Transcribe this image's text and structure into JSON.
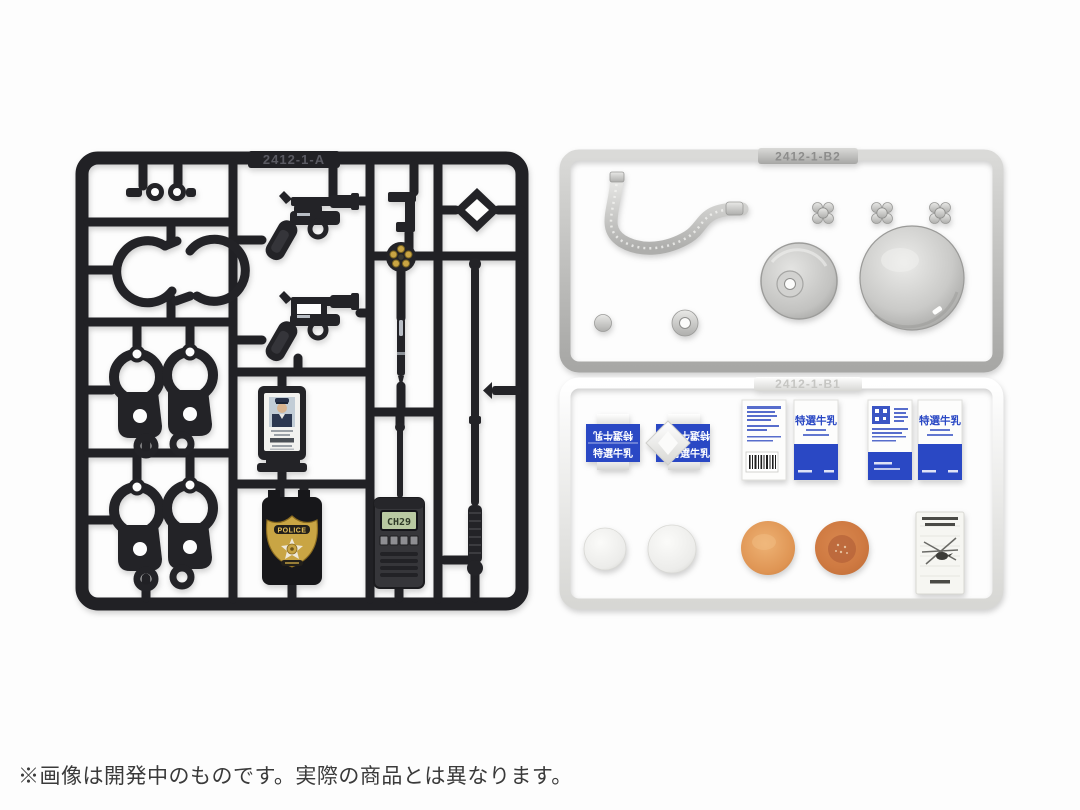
{
  "caption": "※画像は開発中のものです。実際の商品とは異なります。",
  "colors": {
    "black_plastic": "#212125",
    "silver_plastic": "#c6c6c4",
    "white_plastic": "#f2f2f0",
    "milk_blue": "#2a48c4",
    "bun_orange": "#d88a4e",
    "badge_gold": "#c9a544",
    "lcd_green": "#b9c9a2"
  },
  "sprues": {
    "black": {
      "label": "2412-1-A",
      "parts": [
        "handcuff-chain-link",
        "open-handcuffs",
        "handcuffs-pair-1",
        "handcuffs-pair-2",
        "revolver",
        "revolver-open-frame",
        "holster-clip",
        "revolver-cylinder-with-bullets",
        "diamond-ring",
        "pen",
        "police-id-card",
        "police-badge-wallet",
        "handheld-radio",
        "telescopic-baton"
      ]
    },
    "silver": {
      "label": "2412-1-B2",
      "parts": [
        "flexible-hose",
        "faucet-handle-1",
        "faucet-handle-2",
        "faucet-handle-3",
        "pot-lid-with-hole",
        "metal-bowl",
        "small-disc",
        "washer-ring"
      ]
    },
    "white": {
      "label": "2412-1-B1",
      "parts": [
        "milk-carton-top",
        "milk-carton-top-opened",
        "milk-carton-side-nutrition",
        "milk-carton-side-front-1",
        "milk-carton-side-back",
        "milk-carton-side-front-2",
        "steamed-bun-1",
        "steamed-bun-2",
        "baked-bun-1",
        "baked-bun-2",
        "notice-flyer"
      ]
    }
  },
  "labels": {
    "badge": "POLICE",
    "radio_display": "CH29",
    "milk": "特選牛乳"
  }
}
